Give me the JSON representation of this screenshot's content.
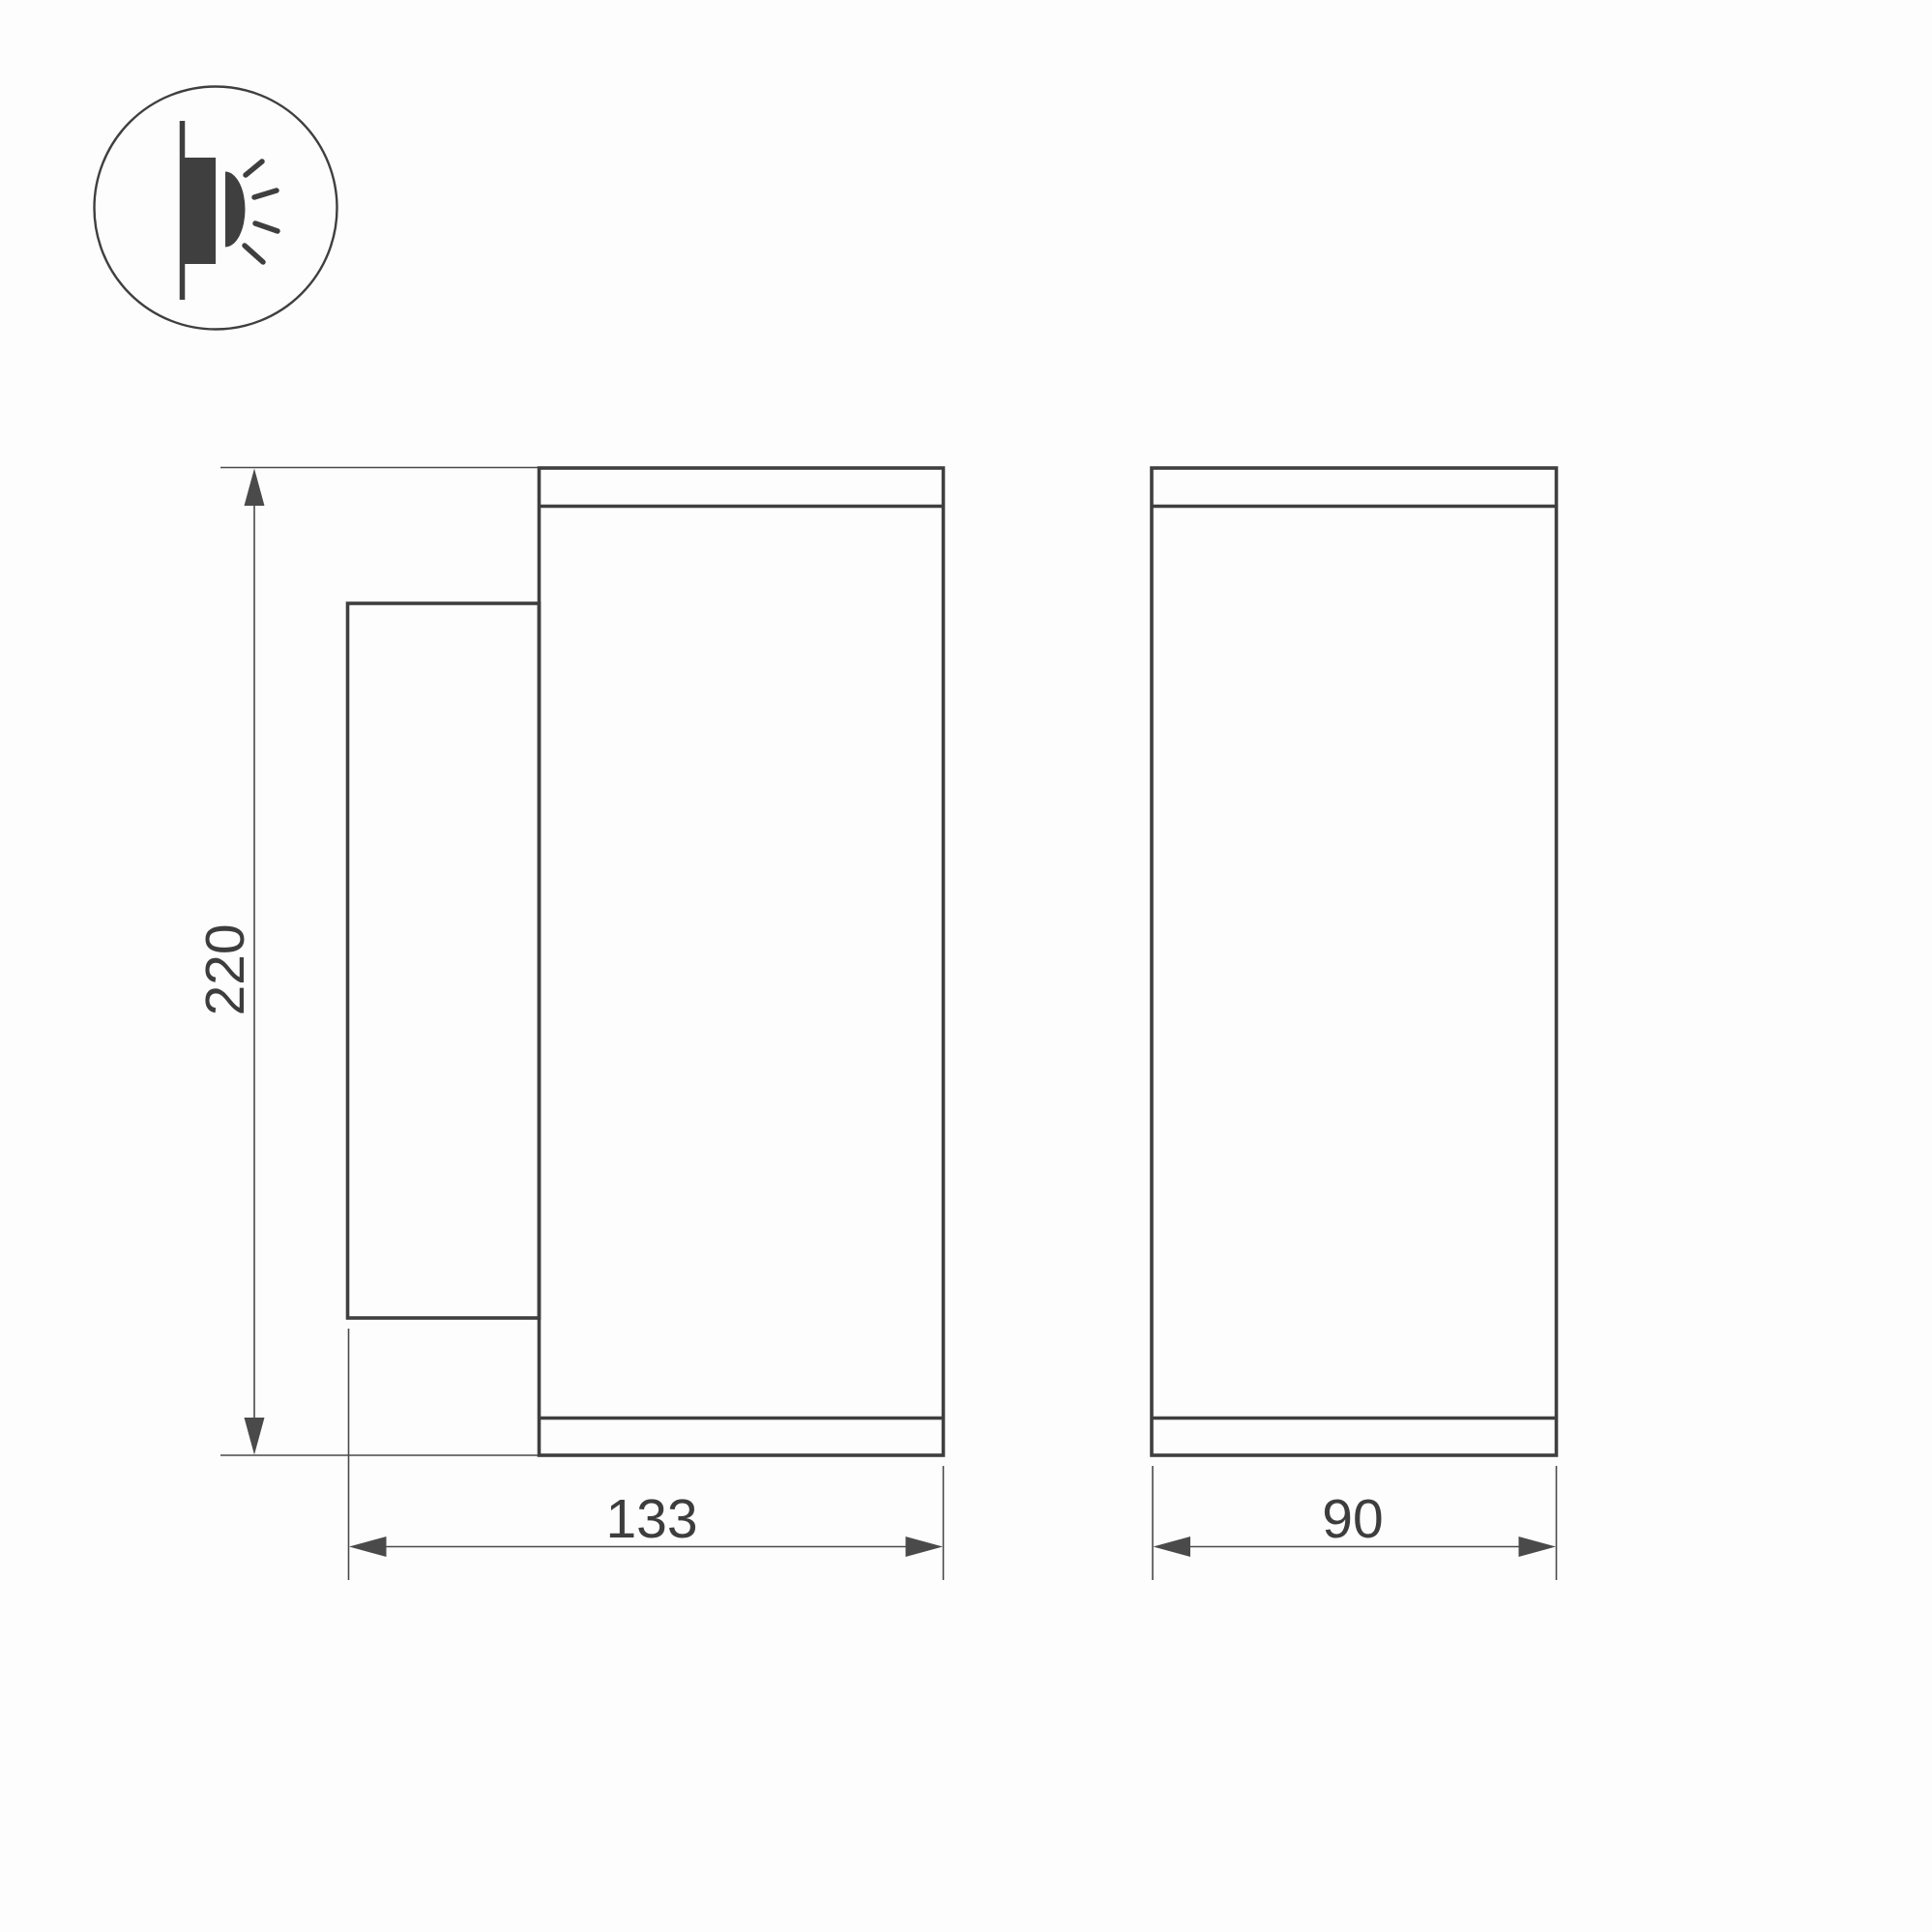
{
  "document": {
    "type": "technical-dimension-drawing",
    "subject": "Wall-mounted luminaire — side view and front view with overall dimensions",
    "background": "#fdfdfe"
  },
  "colors": {
    "line": "#3f3f3f",
    "dim_line": "#4a4a4a",
    "text": "#3d3d3d"
  },
  "icon": {
    "name": "wall-light-side-emission-icon",
    "meaning": "surface wall-mount fixture emitting light sideways"
  },
  "dimensions": {
    "height": "220",
    "side_width": "133",
    "front_width": "90"
  }
}
